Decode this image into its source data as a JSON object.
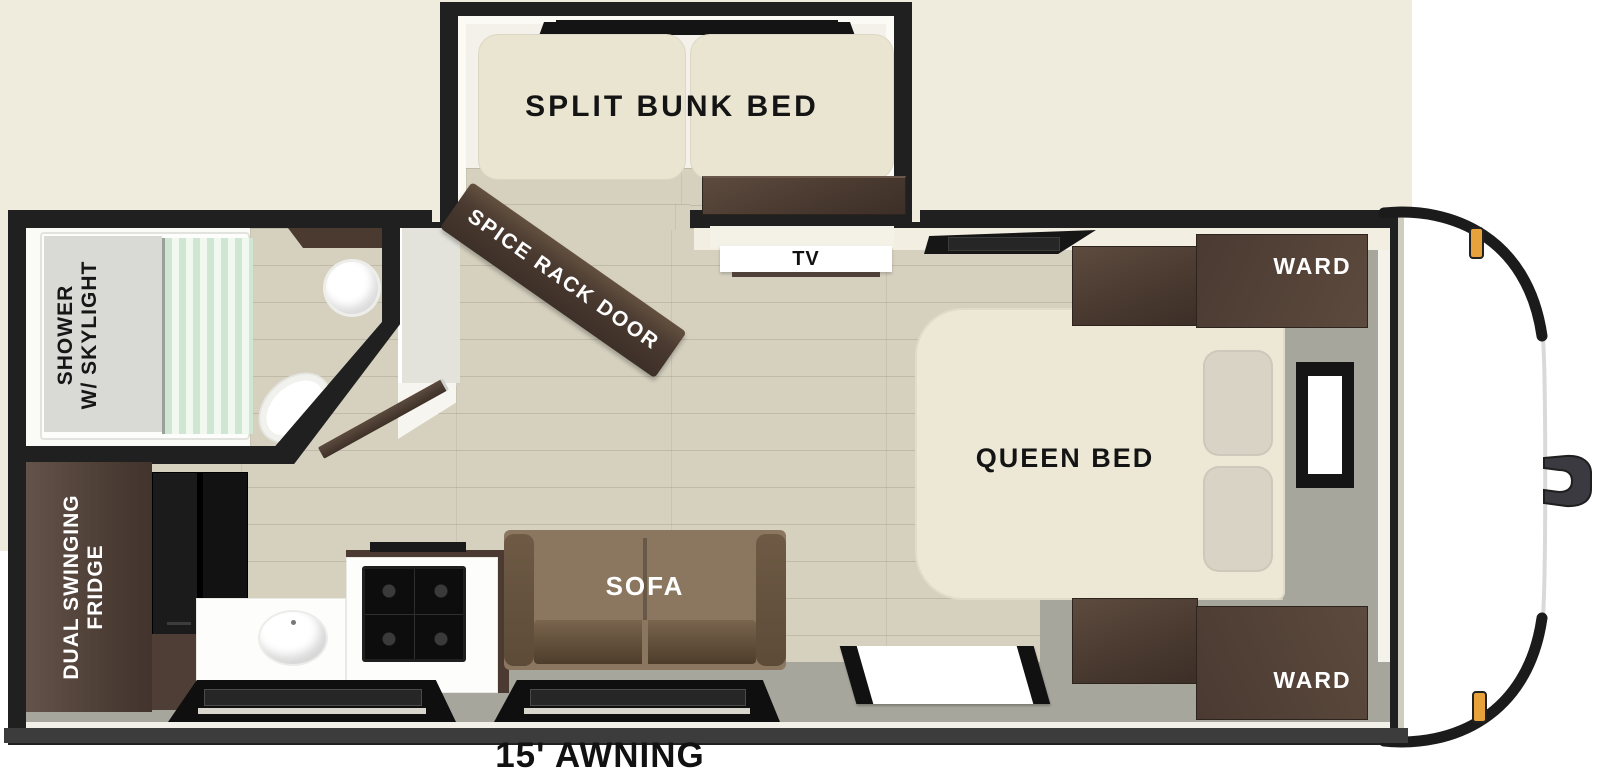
{
  "floorplan": {
    "bunk_room": {
      "label": "SPLIT BUNK BED"
    },
    "bathroom": {
      "shower_label_line1": "SHOWER",
      "shower_label_line2": "W/ SKYLIGHT"
    },
    "kitchen": {
      "fridge_label_line1": "DUAL SWINGING",
      "fridge_label_line2": "FRIDGE"
    },
    "living": {
      "sofa_label": "SOFA",
      "tv_label": "TV",
      "spice_rack_door_label": "SPICE RACK DOOR"
    },
    "bedroom": {
      "bed_label": "QUEEN BED",
      "wardrobe_top_label": "WARD",
      "wardrobe_bottom_label": "WARD"
    },
    "exterior": {
      "awning_label": "15' AWNING"
    }
  },
  "colors": {
    "wall_black": "#202020",
    "trim_cream": "#efecdd",
    "floor_wood": "#d6d1bf",
    "deck_gray": "#a7a69c",
    "cabinet_wood": "#4a3a30",
    "mattress_cream": "#eae6d2",
    "sofa_brown": "#8b7660",
    "curtain_mint": "#cfe7d2",
    "marker_light_amber": "#e8a23c"
  }
}
